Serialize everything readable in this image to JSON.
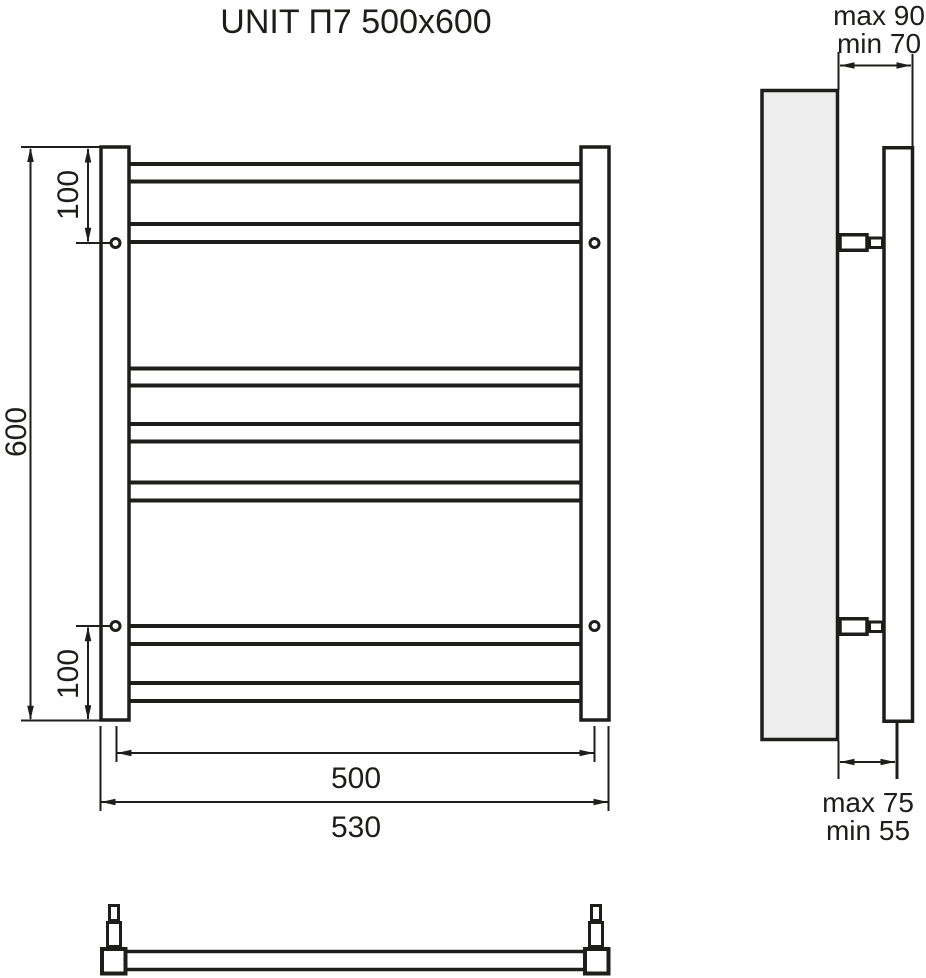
{
  "title": "UNIT П7 500x600",
  "colors": {
    "line": "#1d1d1b",
    "wall_fill": "#ededed",
    "background": "#ffffff"
  },
  "front_view": {
    "height_label": "600",
    "top_hole_offset_label": "100",
    "bottom_hole_offset_label": "100",
    "mount_spacing_label": "500",
    "overall_width_label": "530"
  },
  "side_view": {
    "wall_top_clearance_max_label": "max 90",
    "wall_top_clearance_min_label": "min 70",
    "wall_bottom_clearance_max_label": "max 75",
    "wall_bottom_clearance_min_label": "min 55"
  }
}
